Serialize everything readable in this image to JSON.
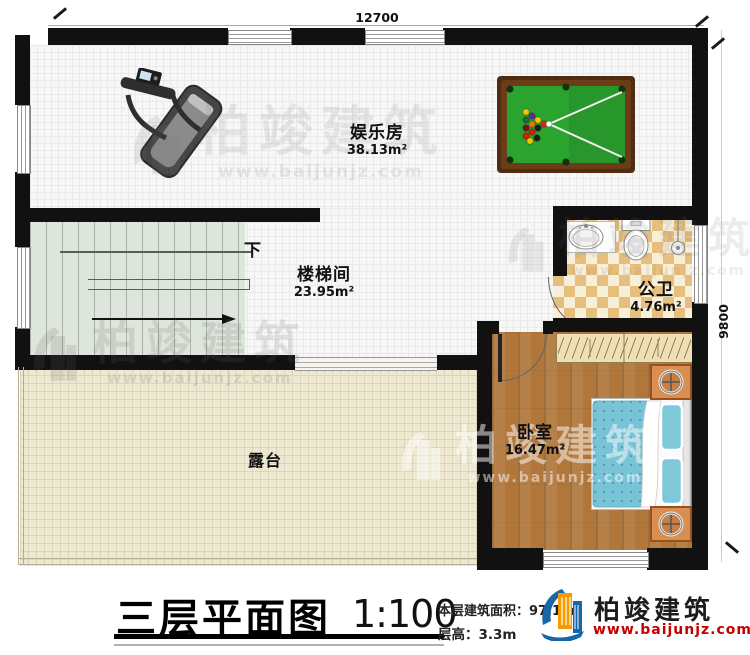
{
  "plan": {
    "dimension_top": "12700",
    "dimension_right": "9800",
    "stairs_direction": "下"
  },
  "rooms": [
    {
      "name": "娱乐房",
      "area": "38.13m²"
    },
    {
      "name": "楼梯间",
      "area": "23.95m²"
    },
    {
      "name": "公卫",
      "area": "4.76m²"
    },
    {
      "name": "卧室",
      "area": "16.47m²"
    },
    {
      "name": "露台",
      "area": ""
    }
  ],
  "title_block": {
    "title": "三层平面图",
    "scale": "1:100",
    "area_label": "本层建筑面积：",
    "area_value": "97.1m²",
    "height_label": "层高：",
    "height_value": "3.3m"
  },
  "brand": {
    "name": "柏竣建筑",
    "url": "www.baijunjz.com"
  },
  "watermark": {
    "text": "柏竣建筑",
    "url": "www.baijunjz.com"
  },
  "colors": {
    "wall": "#111111",
    "brand_red": "#c40000",
    "brand_blue": "#1766a6",
    "brand_orange": "#f59a00",
    "felt_green": "#2ba32f",
    "bed_blue": "#79c3d6",
    "wood": "#b0763a"
  }
}
